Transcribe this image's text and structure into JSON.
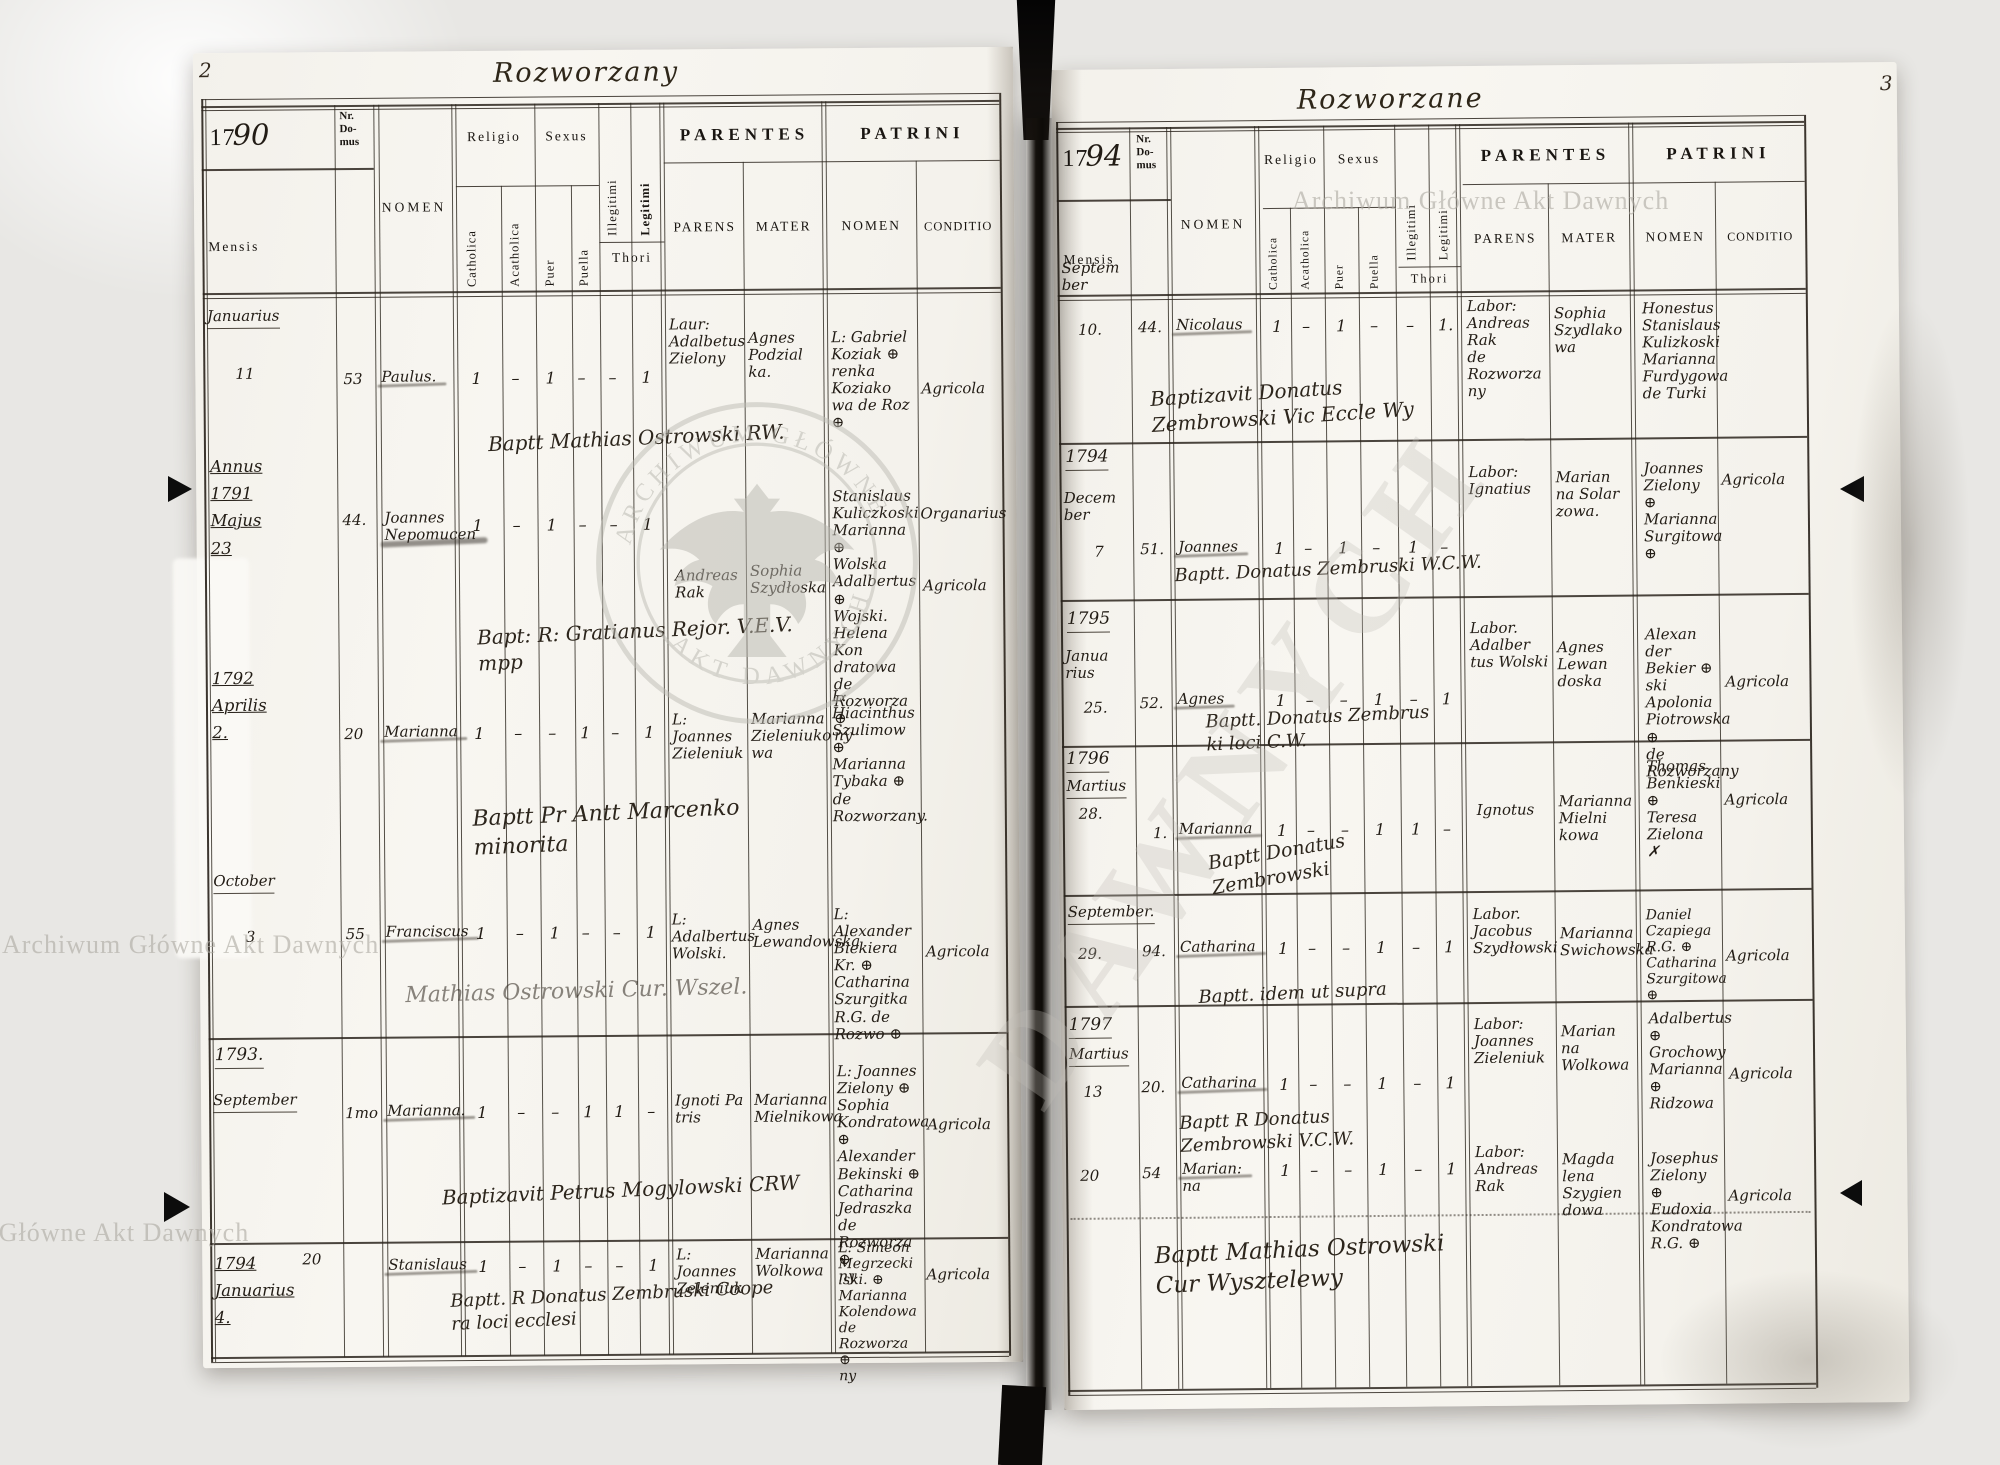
{
  "watermarks": {
    "line": "Archiwum Główne Akt Dawnych",
    "circle_top": "ARCHIWUM GŁÓWNE",
    "circle_bottom": "AKT DAWNYCH",
    "diagonal": "DAWNYCH"
  },
  "labels": {
    "century": "17",
    "nr_domus": "Nr.\nDo-\nmus",
    "mensis": "Mensis",
    "nomen": "NOMEN",
    "religio": "Religio",
    "catholica": "Catholica",
    "acatholica": "Acatholica",
    "sexus": "Sexus",
    "puer": "Puer",
    "puella": "Puella",
    "illegitimi": "Illegitimi",
    "legitimi": "Legitimi",
    "thori": "Thori",
    "parentes": "PARENTES",
    "parens": "PARENS",
    "mater": "MATER",
    "patrini": "PATRINI",
    "conditio": "CONDITIO"
  },
  "left": {
    "page_number": "2",
    "title": "Rozworzany",
    "year_hand": "90",
    "entries": [
      {
        "m": "Januarius",
        "d": "11",
        "nr": "53",
        "nom": "Paulus.",
        "c": "1",
        "a": "–",
        "pr": "1",
        "pl": "–",
        "il": "–",
        "lg": "1",
        "par": "Laur:\nAdalbetus\nZielony",
        "mat": "Agnes\nPodzial\nka.",
        "pat": "L: Gabriel\nKoziak ⊕\nrenka\nKoziako\nwa de Roz ⊕",
        "con": "Agricola",
        "note": "Baptt Mathias Ostrowski RW."
      },
      {
        "y": "Annus\n1791\nMajus\n23",
        "nr": "44.",
        "nom": "Joannes\nNepomucen",
        "c": "1",
        "a": "–",
        "pr": "1",
        "pl": "–",
        "il": "–",
        "lg": "1",
        "par": "Andreas\nRak",
        "mat": "Sophia\nSzydłoska",
        "pat": "Stanislaus\nKuliczkoski\nMarianna ⊕\nWolska\nAdalbertus ⊕\nWojski.\nHelena Kon\ndratowa\nde Rozworza ⊕\nny",
        "con": "Organarius",
        "con2": "Agricola",
        "note": "Bapt: R: Gratianus Rejor. V.E.V.\nmpp"
      },
      {
        "y": "1792\nAprilis\n2.",
        "nr": "20",
        "nom": "Marianna",
        "c": "1",
        "a": "–",
        "pr": "–",
        "pl": "1",
        "il": "–",
        "lg": "1",
        "par": "L: Joannes\nZieleniuk",
        "mat": "Marianna\nZieleniuko\nwa",
        "pat": "L: Hiacinthus\nSzulimow ⊕\nMarianna\nTybaka ⊕\nde Rozworzany.",
        "note": "Baptt Pr Antt Marcenko\nminorita"
      },
      {
        "m": "October",
        "d": "3",
        "nr": "55",
        "nom": "Franciscus",
        "c": "1",
        "a": "–",
        "pr": "1",
        "pl": "–",
        "il": "–",
        "lg": "1",
        "par": "L: Adalbertus\nWolski.",
        "mat": "Agnes\nLewandowska",
        "pat": "L: Alexander\nBiekiera Kr. ⊕\nCatharina\nSzurgitka\nR.G. de Rozwo ⊕",
        "con": "Agricola",
        "note": "Mathias Ostrowski Cur. Wszel."
      },
      {
        "y": "1793.",
        "m": "September",
        "nr": "1mo",
        "nom": "Marianna.",
        "c": "1",
        "a": "–",
        "pr": "–",
        "pl": "1",
        "il": "1",
        "lg": "–",
        "par": "Ignoti Pa\ntris",
        "mat": "Marianna\nMielnikowa",
        "pat": "L: Joannes\nZielony ⊕\nSophia\nKondratowa ⊕\nAlexander\nBekinski ⊕\nCatharina\nJedraszka\nde Rozworza ⊕\nny",
        "con": "Agricola",
        "note": "Baptizavit Petrus Mogylowski CRW"
      },
      {
        "y": "1794\nJanuarius\n4.",
        "nr": "20",
        "nom": "Stanislaus",
        "c": "1",
        "a": "–",
        "pr": "1",
        "pl": "–",
        "il": "–",
        "lg": "1",
        "par": "L: Joannes\nZeleniuk",
        "mat": "Marianna\nWolkowa",
        "pat": "L: Simeon\nMegrzecki\nlski. ⊕\nMarianna\nKolendowa\nde Rozworza ⊕\nny",
        "con": "Agricola",
        "note": "Baptt. R Donatus Zembruski Coope\nra loci ecclesi"
      }
    ]
  },
  "right": {
    "page_number": "3",
    "title": "Rozworzane",
    "year_hand": "94",
    "entries": [
      {
        "m": "Septem\nber",
        "d": "10.",
        "nr": "44.",
        "nom": "Nicolaus",
        "c": "1",
        "a": "–",
        "pr": "1",
        "pl": "–",
        "il": "–",
        "lg": "1.",
        "par": "Labor:\nAndreas\nRak\nde Rozworza\nny",
        "mat": "Sophia\nSzydlako\nwa",
        "pat": "Honestus\nStanislaus\nKulizkoski\nMarianna\nFurdygowa\nde Turki",
        "note": "Baptizavit Donatus\nZembrowski Vic Eccle Wy"
      },
      {
        "y": "1794",
        "m": "Decem\nber",
        "d": "7",
        "nr": "51.",
        "nom": "Joannes",
        "c": "1",
        "a": "–",
        "pr": "1",
        "pl": "–",
        "il": "1",
        "lg": "–",
        "par": "Labor:\nIgnatius",
        "mat": "Marian\nna Solar\nzowa.",
        "pat": "Joannes\nZielony ⊕\nMarianna\nSurgitowa ⊕",
        "con": "Agricola",
        "note": "Baptt. Donatus Zembruski W.C.W."
      },
      {
        "y": "1795",
        "m": "Janua\nrius",
        "d": "25.",
        "nr": "52.",
        "nom": "Agnes",
        "c": "1",
        "a": "–",
        "pr": "–",
        "pl": "1",
        "il": "–",
        "lg": "1",
        "par": "Labor.\nAdalber\ntus Wolski",
        "mat": "Agnes\nLewan\ndoska",
        "pat": "Alexan\nder Bekier ⊕\nski\nApolonia\nPiotrowska ⊕\nde Rozworzany",
        "con": "Agricola",
        "note": "Baptt. Donatus Zembrus\nki loci C.W."
      },
      {
        "y": "1796",
        "m": "Martius",
        "d": "28.",
        "nr": "1.",
        "nom": "Marianna",
        "c": "1",
        "a": "–",
        "pr": "–",
        "pl": "1",
        "il": "1",
        "lg": "–",
        "par": "Ignotus",
        "mat": "Marianna\nMielni\nkowa",
        "pat": "Thomas\nBenkieski ⊕\nTeresa\nZielona ✗",
        "con": "Agricola",
        "note": "Baptt Donatus\nZembrowski"
      },
      {
        "m": "September.",
        "d": "29.",
        "nr": "94.",
        "nom": "Catharina",
        "c": "1",
        "a": "–",
        "pr": "–",
        "pl": "1",
        "il": "–",
        "lg": "1",
        "par": "Labor.\nJacobus\nSzydłowski",
        "mat": "Marianna\nSwichowska",
        "pat": "Daniel\nCzapiega R.G. ⊕\nCatharina\nSzurgitowa ⊕",
        "con": "Agricola",
        "note": "Baptt. idem ut supra"
      },
      {
        "y": "1797",
        "m": "Martius",
        "d": "13",
        "nr": "20.",
        "nom": "Catharina",
        "c": "1",
        "a": "–",
        "pr": "–",
        "pl": "1",
        "il": "–",
        "lg": "1",
        "par": "Labor:\nJoannes\nZieleniuk",
        "mat": "Marian\nna\nWolkowa",
        "pat": "Adalbertus ⊕\nGrochowy\nMarianna ⊕\nRidzowa",
        "con": "Agricola",
        "note": "Baptt R Donatus\nZembrowski V.C.W."
      },
      {
        "d": "20",
        "nr": "54",
        "nom": "Marian:\nna",
        "c": "1",
        "a": "–",
        "pr": "–",
        "pl": "1",
        "il": "–",
        "lg": "1",
        "par": "Labor:\nAndreas\nRak",
        "mat": "Magda\nlena\nSzygien\ndowa",
        "pat": "Josephus\nZielony ⊕\nEudoxia\nKondratowa\nR.G. ⊕",
        "con": "Agricola",
        "note": "Baptt Mathias Ostrowski\nCur Wysztelewy"
      }
    ]
  }
}
